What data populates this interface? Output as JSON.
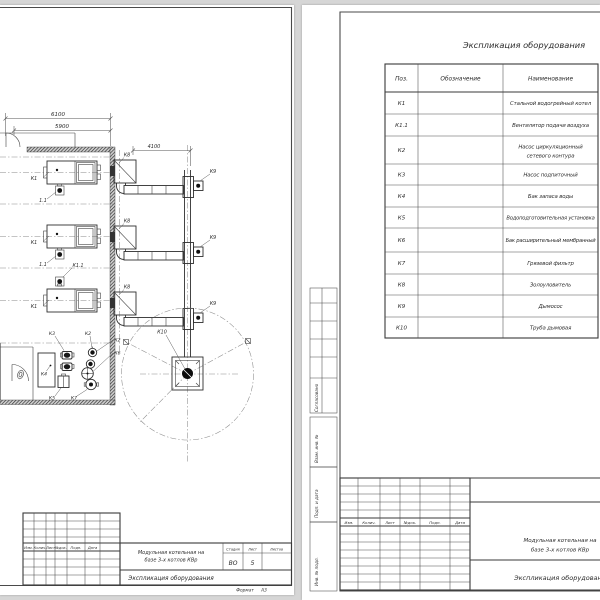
{
  "plan": {
    "dim_6100": "6100",
    "dim_5900": "5900",
    "dim_4100": "4100",
    "k1": "К1",
    "k1_fan_short": "1.1",
    "k1_fan": "К1.1",
    "k2": "К2",
    "k3": "К3",
    "k4": "К4",
    "k5": "К5",
    "k6": "К6",
    "k7": "К7",
    "k8": "К8",
    "k9": "К9",
    "k10": "К10"
  },
  "left_stamp": {
    "cols": [
      "Изм.",
      "Колич.",
      "Лист",
      "№док.",
      "Подп.",
      "Дата"
    ],
    "project1": "Модульная котельная на",
    "project2": "базе 3-х котлов КВр",
    "doc": "Экспликация оборудования",
    "stage_h": "Стадия",
    "sheet_h": "Лист",
    "sheets_h": "Листов",
    "stage": "ВО",
    "sheet": "5",
    "format_label": "Формат",
    "format": "А3"
  },
  "spec": {
    "title": "Экспликация оборудования",
    "h_pos": "Поз.",
    "h_mark": "Обозначение",
    "h_name": "Наименование",
    "rows": [
      {
        "pos": "К1",
        "name": "Стальной водогрейный котел"
      },
      {
        "pos": "К1.1",
        "name": "Вентилятор подачи воздуха"
      },
      {
        "pos": "К2",
        "name": "Насос циркуляционный",
        "name2": "сетевого контура"
      },
      {
        "pos": "К3",
        "name": "Насос подпиточный"
      },
      {
        "pos": "К4",
        "name": "Бак запаса воды"
      },
      {
        "pos": "К5",
        "name": "Водоподготовительная установка"
      },
      {
        "pos": "К6",
        "name": "Бак расширительный мембранный"
      },
      {
        "pos": "К7",
        "name": "Грязевой фильтр"
      },
      {
        "pos": "К8",
        "name": "Золоуловитель"
      },
      {
        "pos": "К9",
        "name": "Дымосос"
      },
      {
        "pos": "К10",
        "name": "Труба дымовая"
      }
    ],
    "margin": [
      "Согласовано",
      "Взам. инв. №",
      "Подп. и дата",
      "Инв. № подл."
    ]
  },
  "right_stamp": {
    "cols": [
      "Изм.",
      "Колич.",
      "Лист",
      "№док.",
      "Подп.",
      "Дата"
    ],
    "project1": "Модульная котельная на",
    "project2": "базе 3-х котлов КВр",
    "doc": "Экспликация оборудования"
  }
}
